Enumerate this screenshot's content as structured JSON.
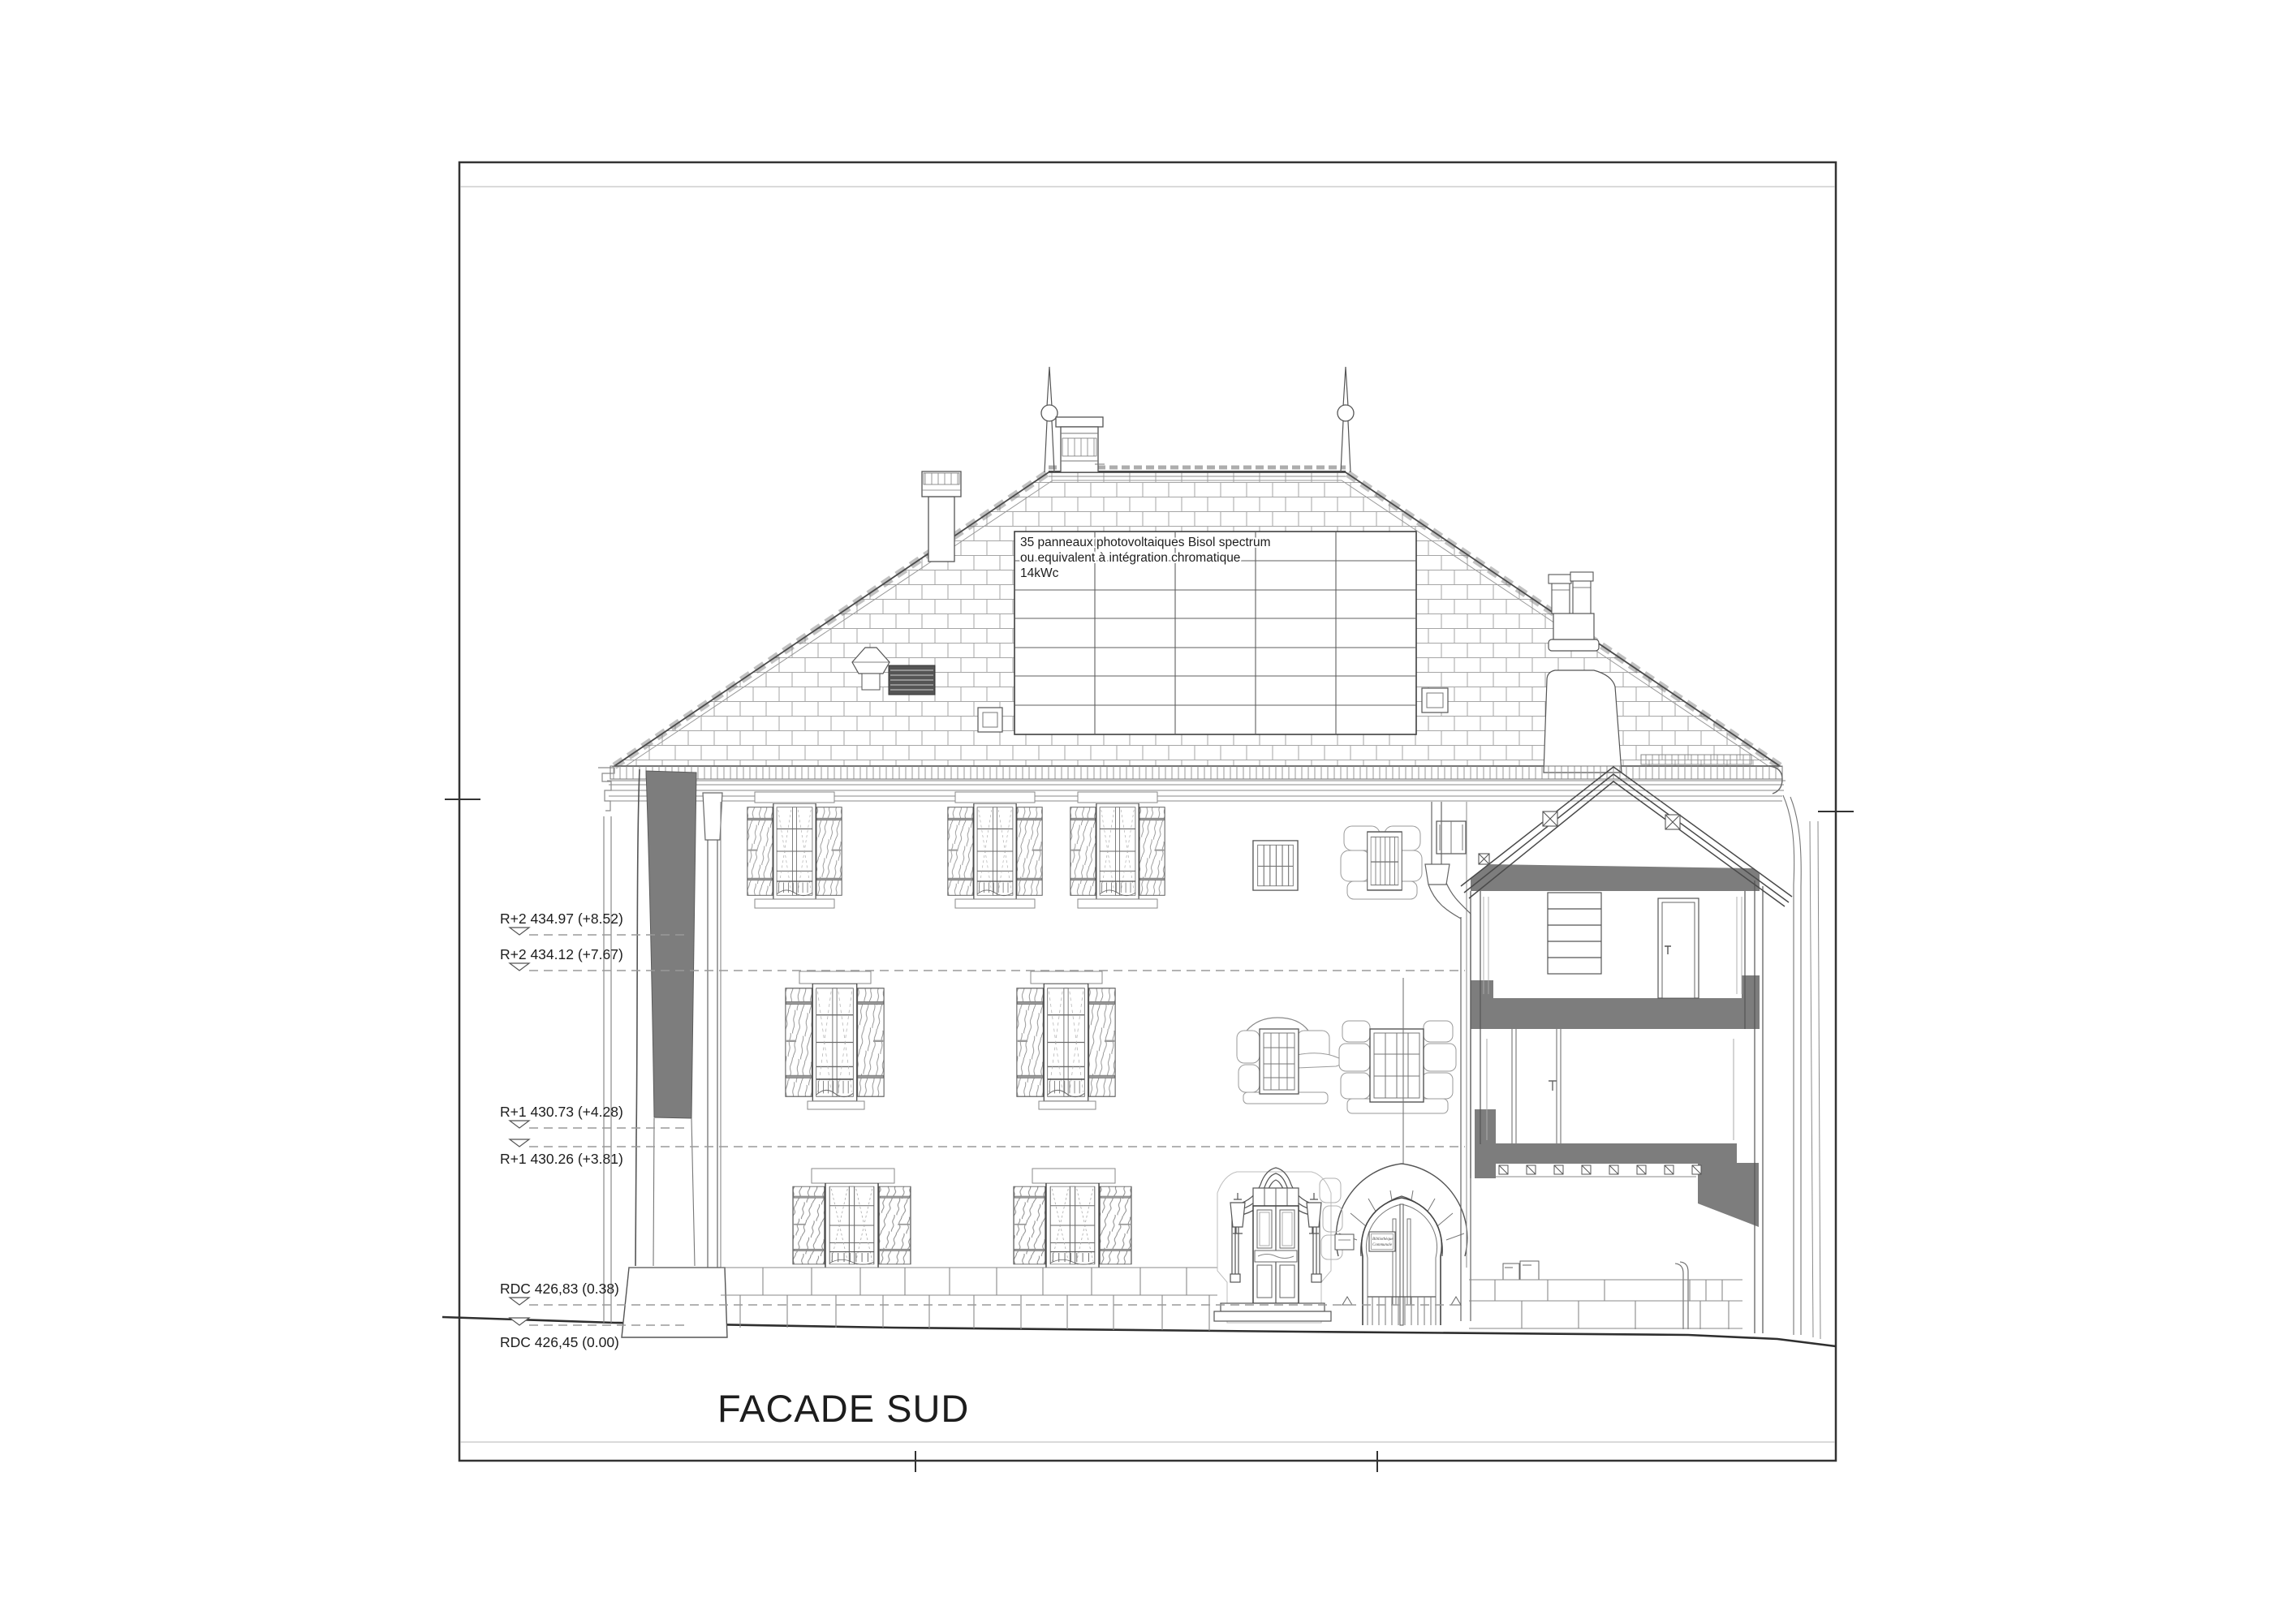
{
  "drawing": {
    "title": "FACADE SUD",
    "solar_note": {
      "line1": "35 panneaux photovoltaiques Bisol spectrum",
      "line2": "ou equivalent à intégration chromatique",
      "line3": "14kWc"
    },
    "levels": [
      {
        "id": "r2-haut",
        "label": "R+2 434.97 (+8.52)"
      },
      {
        "id": "r2",
        "label": "R+2 434.12 (+7.67)"
      },
      {
        "id": "r1-haut",
        "label": "R+1 430.73 (+4.28)"
      },
      {
        "id": "r1",
        "label": "R+1 430.26 (+3.81)"
      },
      {
        "id": "rdc-haut",
        "label": "RDC 426,83 (0.38)"
      },
      {
        "id": "rdc",
        "label": "RDC 426,45 (0.00)"
      }
    ],
    "arch_sign": {
      "line1": "Bibliothèque",
      "line2": "Communale"
    },
    "colors": {
      "section_gray": "#7d7d7d",
      "line_dark": "#2f2f2f",
      "line_mid": "#6e6e6e",
      "line_light": "#a2a2a2",
      "grille_dark": "#555555"
    }
  }
}
